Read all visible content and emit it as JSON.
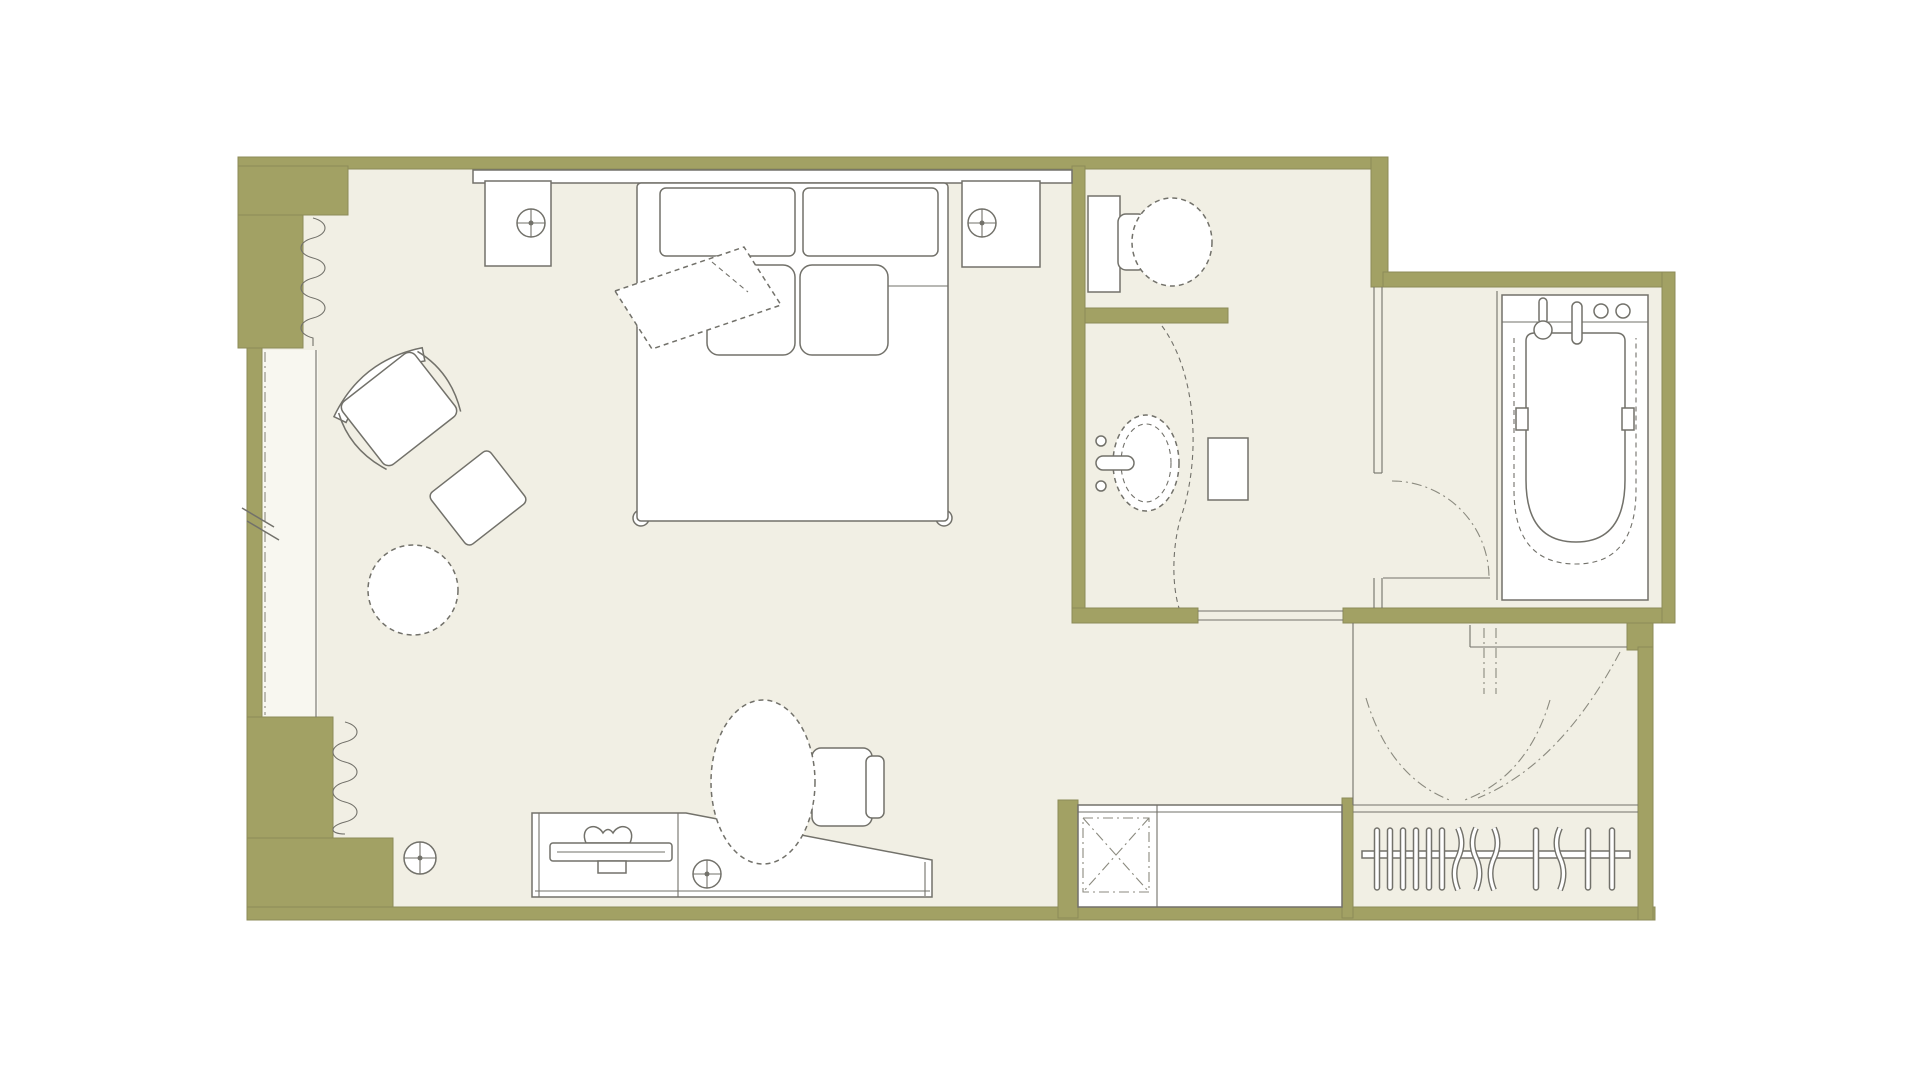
{
  "page": {
    "title": "Hotel guest room floor plan",
    "background": "#ffffff"
  },
  "palette": {
    "wall": "#a2a164",
    "wall_edge": "#8c8b58",
    "floor": "#f1efe4",
    "balcony_floor": "#f8f7f0",
    "furn": "#ffffff",
    "line": "#72716a",
    "soft": "#8b8a7f"
  },
  "plan": {
    "type": "floor-plan",
    "rooms": [
      {
        "name": "bedroom"
      },
      {
        "name": "bathroom"
      },
      {
        "name": "bathtub-room"
      },
      {
        "name": "entry-vestibule"
      },
      {
        "name": "closet"
      },
      {
        "name": "balcony-window"
      }
    ],
    "furniture": [
      {
        "name": "double-bed"
      },
      {
        "name": "headboard-console"
      },
      {
        "name": "headboard-cushions",
        "count": 2
      },
      {
        "name": "pillows",
        "count": 2
      },
      {
        "name": "bed-throw"
      },
      {
        "name": "nightstand",
        "count": 2
      },
      {
        "name": "table-lamp",
        "count": 2
      },
      {
        "name": "armchair"
      },
      {
        "name": "ottoman"
      },
      {
        "name": "round-side-table"
      },
      {
        "name": "floor-lamp"
      },
      {
        "name": "desk"
      },
      {
        "name": "telephone"
      },
      {
        "name": "desk-lamp"
      },
      {
        "name": "desk-chair"
      },
      {
        "name": "luggage-counter"
      },
      {
        "name": "minibar-box"
      },
      {
        "name": "clothes-hangers",
        "count": 13
      }
    ],
    "fixtures": [
      {
        "name": "toilet"
      },
      {
        "name": "vanity-sink"
      },
      {
        "name": "vanity-counter"
      },
      {
        "name": "bathtub"
      },
      {
        "name": "tub-faucet"
      },
      {
        "name": "bathroom-door-opening"
      },
      {
        "name": "tub-room-door-swing"
      },
      {
        "name": "entry-door-swing"
      },
      {
        "name": "closet-door-swings"
      },
      {
        "name": "curtain-zigzag",
        "count": 2
      },
      {
        "name": "window-glazing-line"
      }
    ]
  }
}
